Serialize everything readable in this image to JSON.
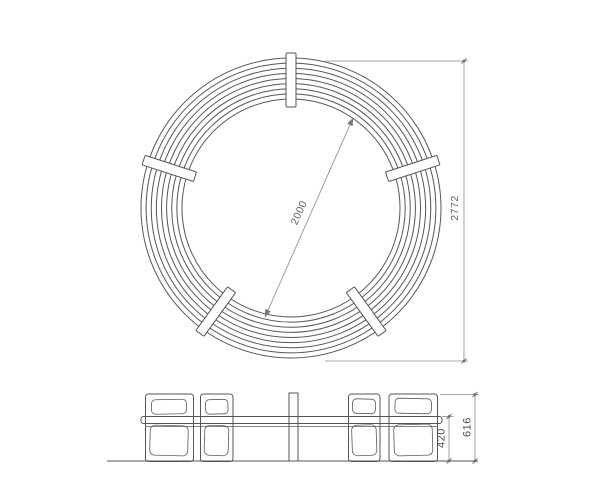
{
  "drawing": {
    "type": "technical-drawing",
    "subject": "circular bench, plan view and front elevation",
    "background_color": "#ffffff",
    "object_line_color": "#565656",
    "dimension_line_color": "#8a8a8a",
    "dimension_text_color": "#5f5f5f"
  },
  "plan_view": {
    "description": "top view of circular bench made of concentric slat rings with radial battens",
    "center": {
      "x": 291,
      "y": 208
    },
    "ring_count": 9,
    "inner_radius_px": 109,
    "outer_radius_px": 150,
    "batten_angles_deg": [
      -90,
      -162,
      -18,
      126,
      54
    ],
    "batten_inner_r_px": 101,
    "batten_outer_r_px": 155,
    "batten_width_px": 10,
    "dim_inner_diameter": {
      "label": "2000"
    },
    "dim_overall_diameter": {
      "label": "2772"
    }
  },
  "elevation_view": {
    "description": "front elevation of bench with four leg blocks, seat rail and central back post",
    "dim_seat_height": {
      "label": "420"
    },
    "dim_overall_height": {
      "label": "616"
    }
  }
}
